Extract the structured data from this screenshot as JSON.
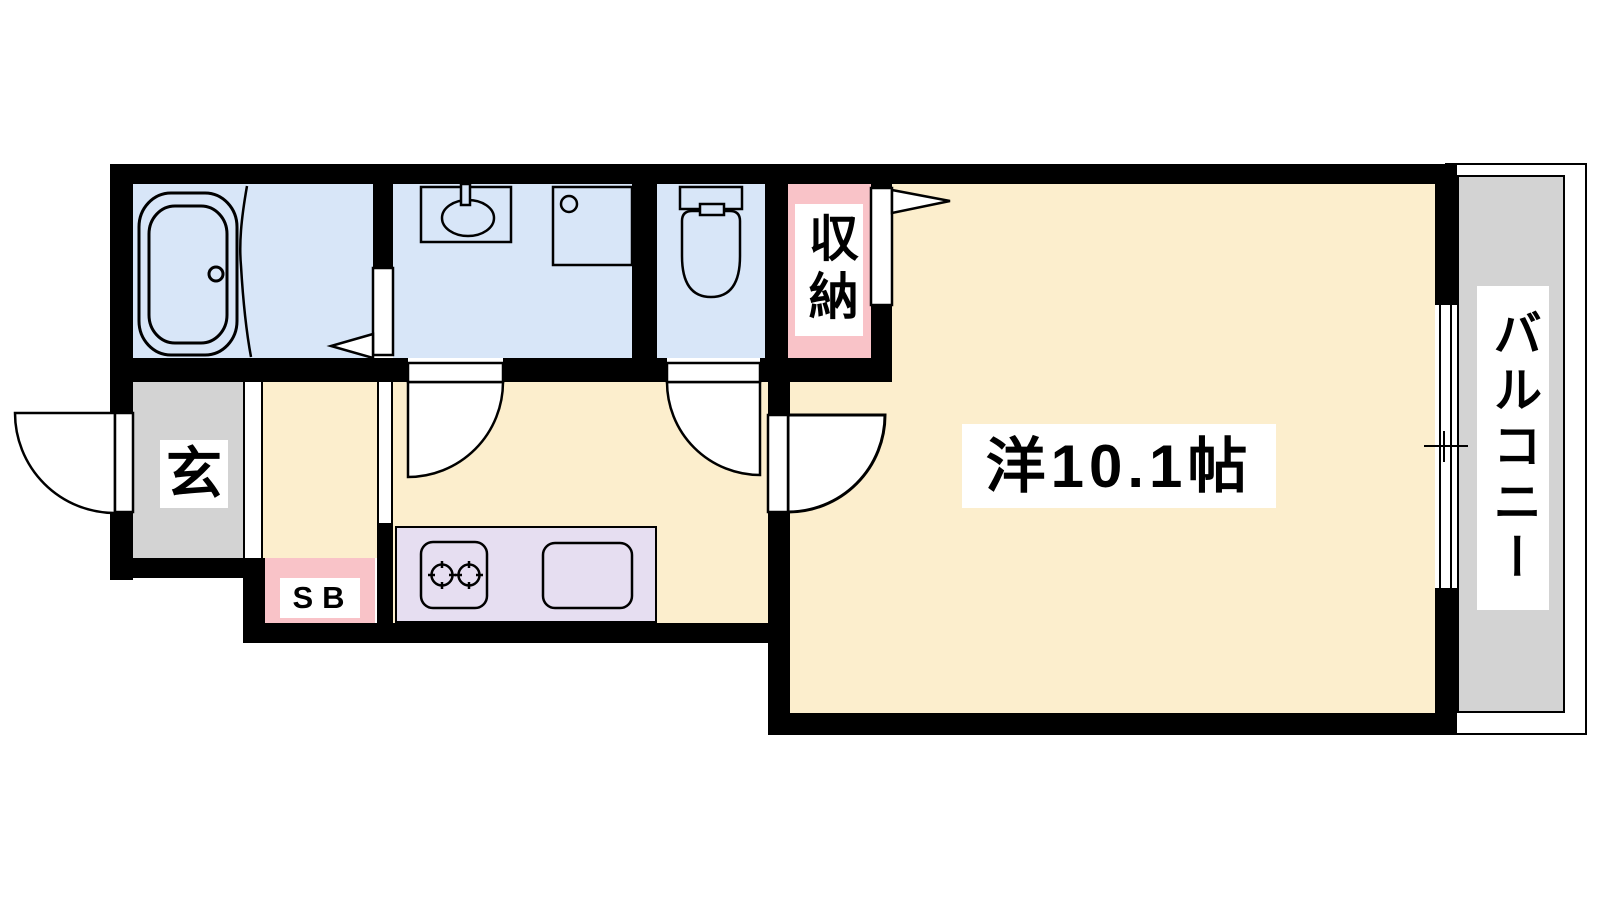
{
  "document": {
    "type": "apartment-floor-plan",
    "unit_layout": "1K"
  },
  "rooms": {
    "entrance": {
      "label": "玄"
    },
    "shoe_box": {
      "label": "SB"
    },
    "closet": {
      "label": "収納"
    },
    "western_room": {
      "label": "洋10.1帖"
    },
    "balcony": {
      "label": "バルコニー"
    }
  },
  "icons": [
    "bathtub-icon",
    "bath-partition-curve-icon",
    "vanity-sink-icon",
    "washing-machine-pan-icon",
    "toilet-icon",
    "stove-icon",
    "kitchen-sink-icon",
    "sliding-window-icon",
    "door-swing-icon",
    "door-pennant-icon"
  ],
  "colors": {
    "wall": "#000000",
    "wet_area_floor": "#D8E6F8",
    "wood_floor": "#FCEECD",
    "closet_fill": "#F9C3C8",
    "entrance_fill": "#D3D3D3",
    "balcony_fill": "#D3D3D3",
    "kitchen_counter_fill": "#E6DEF1",
    "background": "#FFFFFF",
    "label_background": "#FFFFFF",
    "label_text": "#000000"
  }
}
